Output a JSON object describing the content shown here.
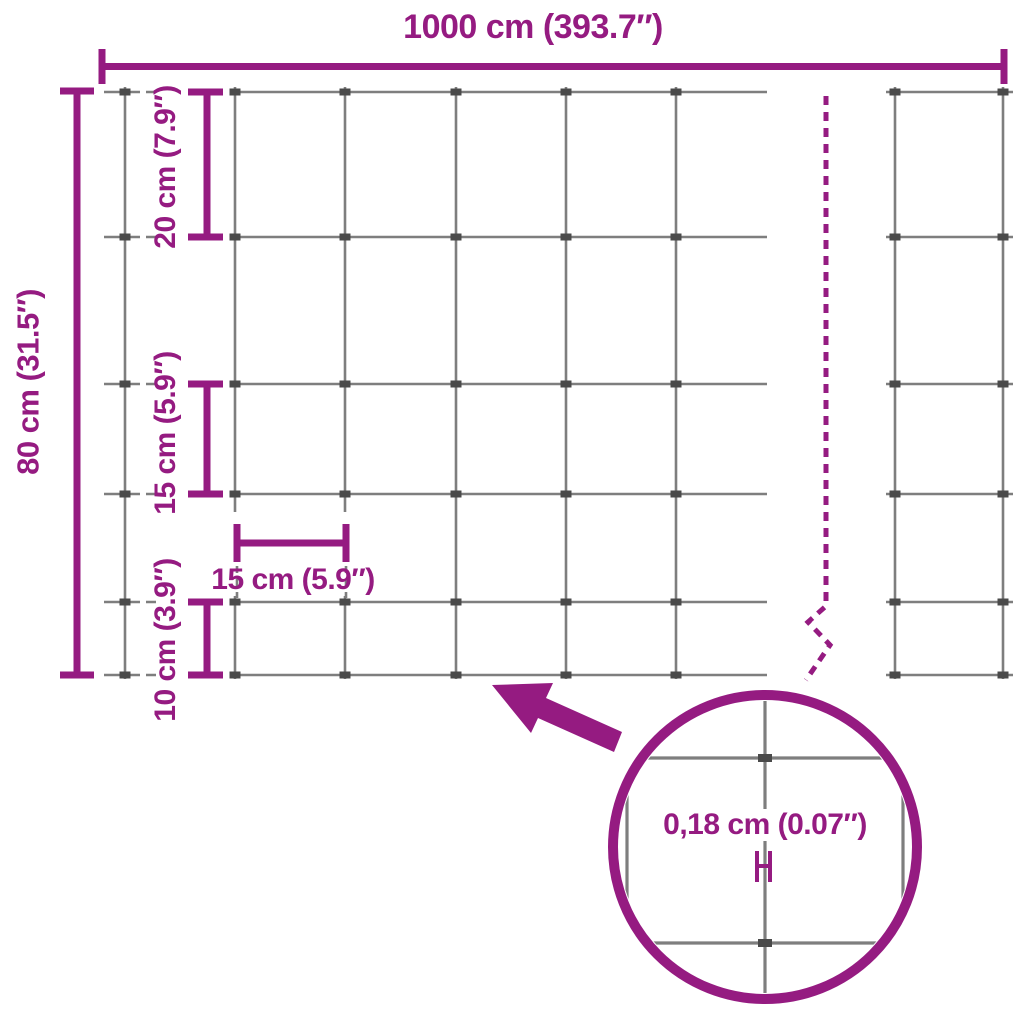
{
  "colors": {
    "accent": "#951b81",
    "wire": "#7e7e7e",
    "clip": "#4a4a4a",
    "background": "#ffffff"
  },
  "labels": {
    "total_width": "1000 cm (393.7″)",
    "total_height": "80 cm (31.5″)",
    "row_gap_top": "20 cm (7.9″)",
    "row_gap_middle": "15 cm (5.9″)",
    "row_gap_bottom": "10 cm (3.9″)",
    "column_gap": "15 cm (5.9″)",
    "wire_thickness": "0,18 cm (0.07″)"
  },
  "icons": {
    "arrow": "zoom-arrow pointing from detail circle to mesh",
    "circle": "magnifier-circle showing wire thickness detail",
    "break_line": "dashed break line indicating continued length"
  },
  "mesh": {
    "horizontal_wire_rows": 6,
    "row_gaps_cm_top_to_bottom": [
      20,
      20,
      15,
      15,
      10
    ],
    "column_gap_cm": 15,
    "wire_thickness_cm": "0,18"
  }
}
